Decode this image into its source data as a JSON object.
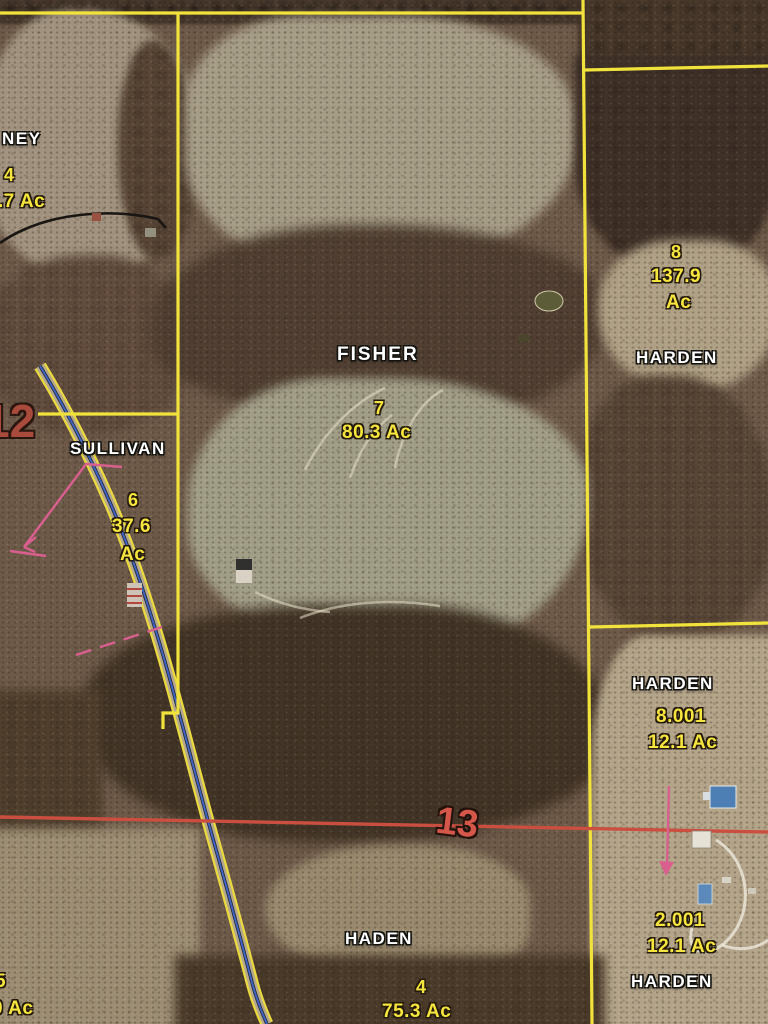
{
  "map": {
    "title": "aerial parcel plat map",
    "sections": [
      {
        "number": "12"
      },
      {
        "number": "13"
      }
    ],
    "parcels": [
      {
        "owner": "NEY",
        "parcel_number": "4",
        "acreage_label": ".7 Ac"
      },
      {
        "owner": "SULLIVAN",
        "parcel_number": "6",
        "acreage_value": "37.6",
        "acreage_unit": "Ac"
      },
      {
        "owner": "FISHER",
        "parcel_number": "7",
        "acreage_label": "80.3 Ac"
      },
      {
        "owner": "HARDEN",
        "parcel_number": "8",
        "acreage_value": "137.9",
        "acreage_unit": "Ac"
      },
      {
        "owner": "HARDEN",
        "parcel_number": "8.001",
        "acreage_label": "12.1 Ac"
      },
      {
        "owner": "HADEN",
        "parcel_number": "4",
        "acreage_label": "75.3 Ac"
      },
      {
        "owner": "HARDEN",
        "parcel_number": "2.001",
        "acreage_label": "12.1 Ac"
      },
      {
        "owner": "",
        "parcel_number": "5",
        "acreage_label": "0 Ac"
      }
    ],
    "colors": {
      "parcel_boundary": "#f2e33c",
      "section_line": "#cb4f40",
      "section_number_12": "#a84a3c",
      "section_number_13": "#d4574a",
      "acreage_text": "#f6e53e",
      "owner_text": "#ffffff",
      "road_center": "#3f63c0",
      "annotation_pink": "#d95f8f"
    }
  }
}
